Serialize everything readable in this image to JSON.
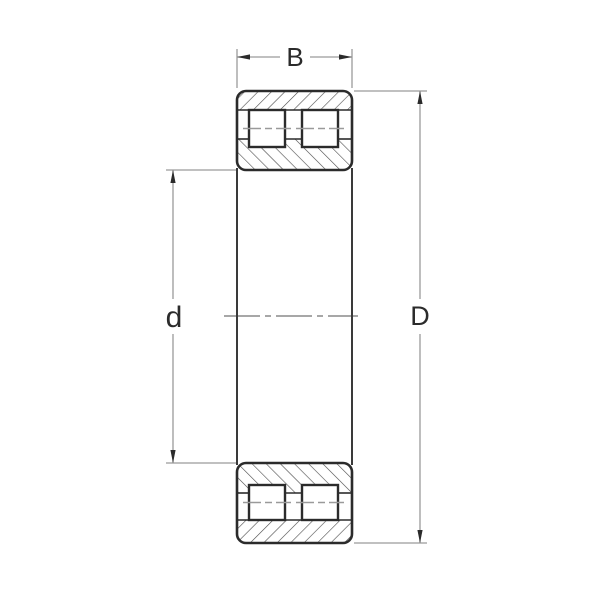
{
  "drawing": {
    "type": "bearing-cross-section-technical-drawing",
    "labels": {
      "width_b": "B",
      "bore_d": "d",
      "outer_D": "D"
    },
    "colors": {
      "background": "#ffffff",
      "outline": "#2b2b2b",
      "hatch": "#4a4a4a",
      "dimension_line": "#9a9a9a",
      "centerline": "#8a8a8a"
    }
  }
}
